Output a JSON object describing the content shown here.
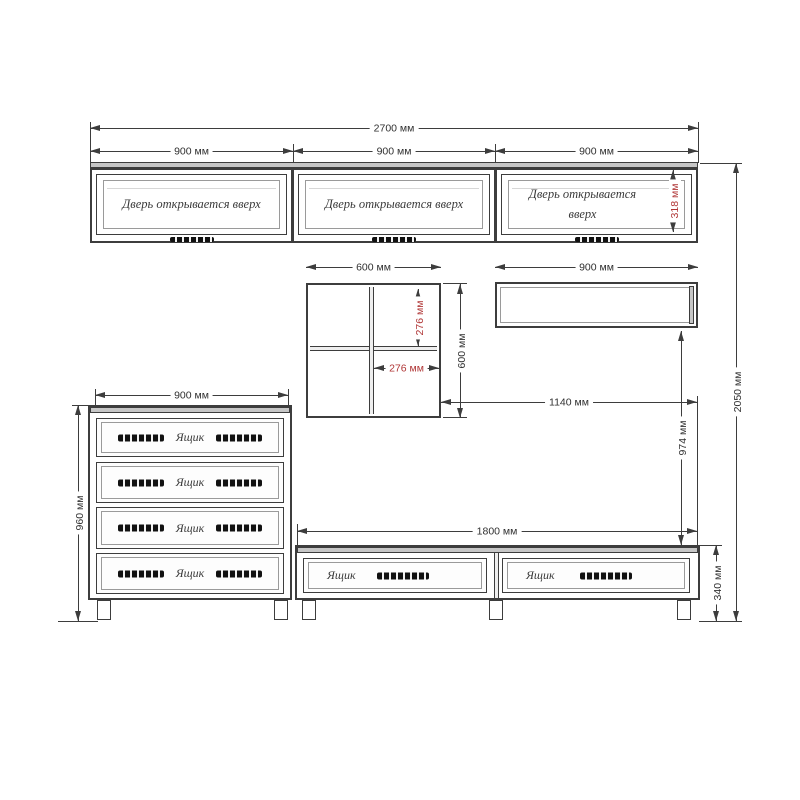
{
  "title": "furniture-wall-unit-technical-drawing",
  "colors": {
    "line": "#3d3d3d",
    "red": "#b03636"
  },
  "units": {
    "wall_cabinets": [
      {
        "label": "Дверь открывается вверх"
      },
      {
        "label": "Дверь открывается вверх"
      },
      {
        "label": "Дверь открывается вверх"
      }
    ],
    "dresser": {
      "drawers": [
        "Ящик",
        "Ящик",
        "Ящик",
        "Ящик"
      ]
    },
    "tv_stand": {
      "drawers": [
        "Ящик",
        "Ящик"
      ]
    }
  },
  "dims": {
    "total_width": "2700 мм",
    "cab1_width": "900 мм",
    "cab2_width": "900 мм",
    "cab3_width": "900 мм",
    "door_height": "318 мм",
    "cube_width": "600 мм",
    "cube_height": "600 мм",
    "cell_width": "276 мм",
    "cell_height": "276 мм",
    "wall_shelf_width": "900 мм",
    "niche_width": "1140 мм",
    "niche_height": "974 мм",
    "total_height": "2050 мм",
    "dresser_width": "900 мм",
    "dresser_height": "960 мм",
    "tv_width": "1800 мм",
    "tv_height": "340 мм"
  }
}
